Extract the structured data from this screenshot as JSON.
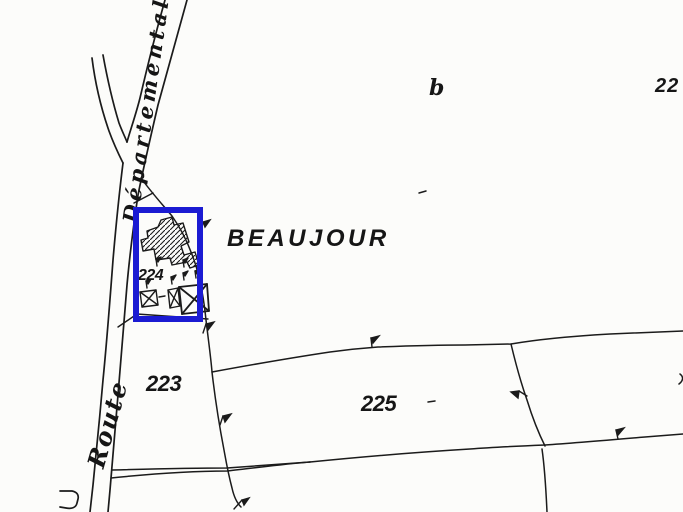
{
  "map": {
    "place_label": "BEAUJOUR",
    "road_name_upper": "Départementale",
    "road_name_lower": "Route",
    "parcel_labels": {
      "p223": "223",
      "p224": "224",
      "p225": "225",
      "p22_partial": "22",
      "section_b": "b"
    },
    "colors": {
      "highlight_blue": "#1b1bd2",
      "ink": "#1b1b1b",
      "paper": "#fcfcfa"
    }
  }
}
